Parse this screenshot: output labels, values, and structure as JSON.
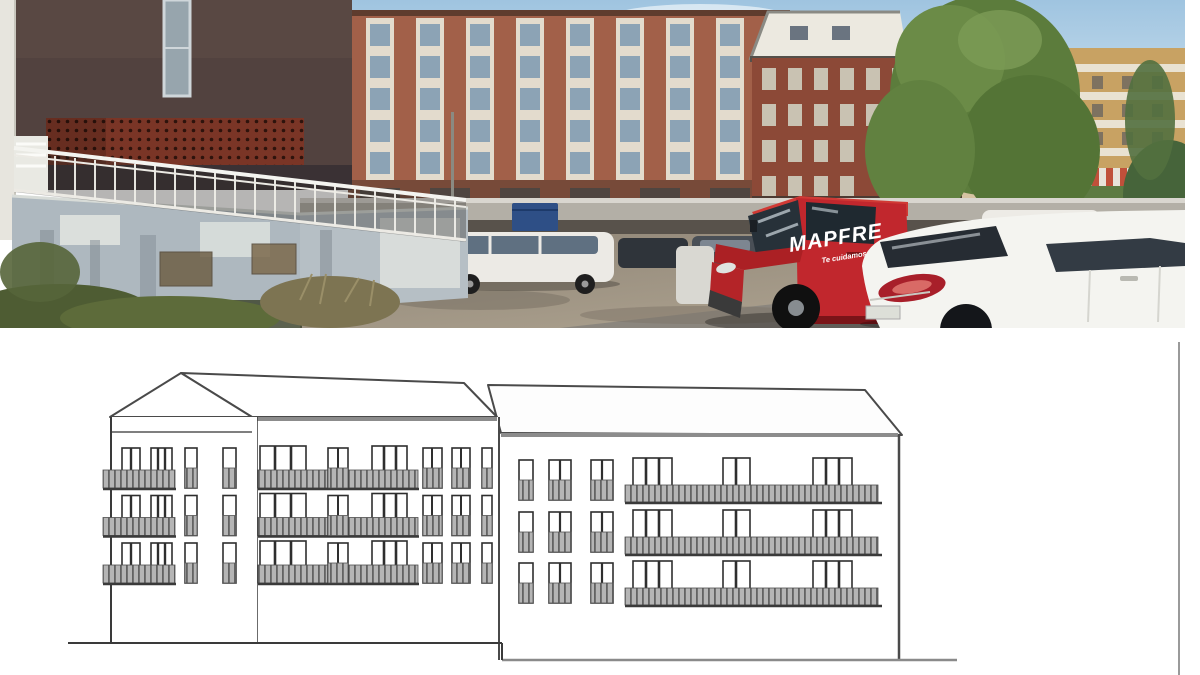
{
  "page": {
    "background": "#ffffff"
  },
  "photo": {
    "van": {
      "brand": "MAPFRE",
      "slogan": "Te cuidamos"
    },
    "colors": {
      "sky": "#a9c9e2",
      "brick_left": "#a26049",
      "brick_center": "#8c4937",
      "tan_building": "#c8a263",
      "foreground_building": "#52423f",
      "lattice_band": "#7a3526",
      "van_red": "#c1272d",
      "tree_green": "#5c7c3c",
      "gravel": "#9a8f80",
      "retaining_wall": "#aeb8bf"
    }
  },
  "drawing": {
    "type": "architectural elevation",
    "blocks": 3,
    "floors_per_block": 3,
    "colors": {
      "line": "#3f3f3f",
      "eave_gray": "#8c8c8c",
      "balcony_fill": "#b5b5b5",
      "balcony_stripe": "#636363"
    }
  }
}
